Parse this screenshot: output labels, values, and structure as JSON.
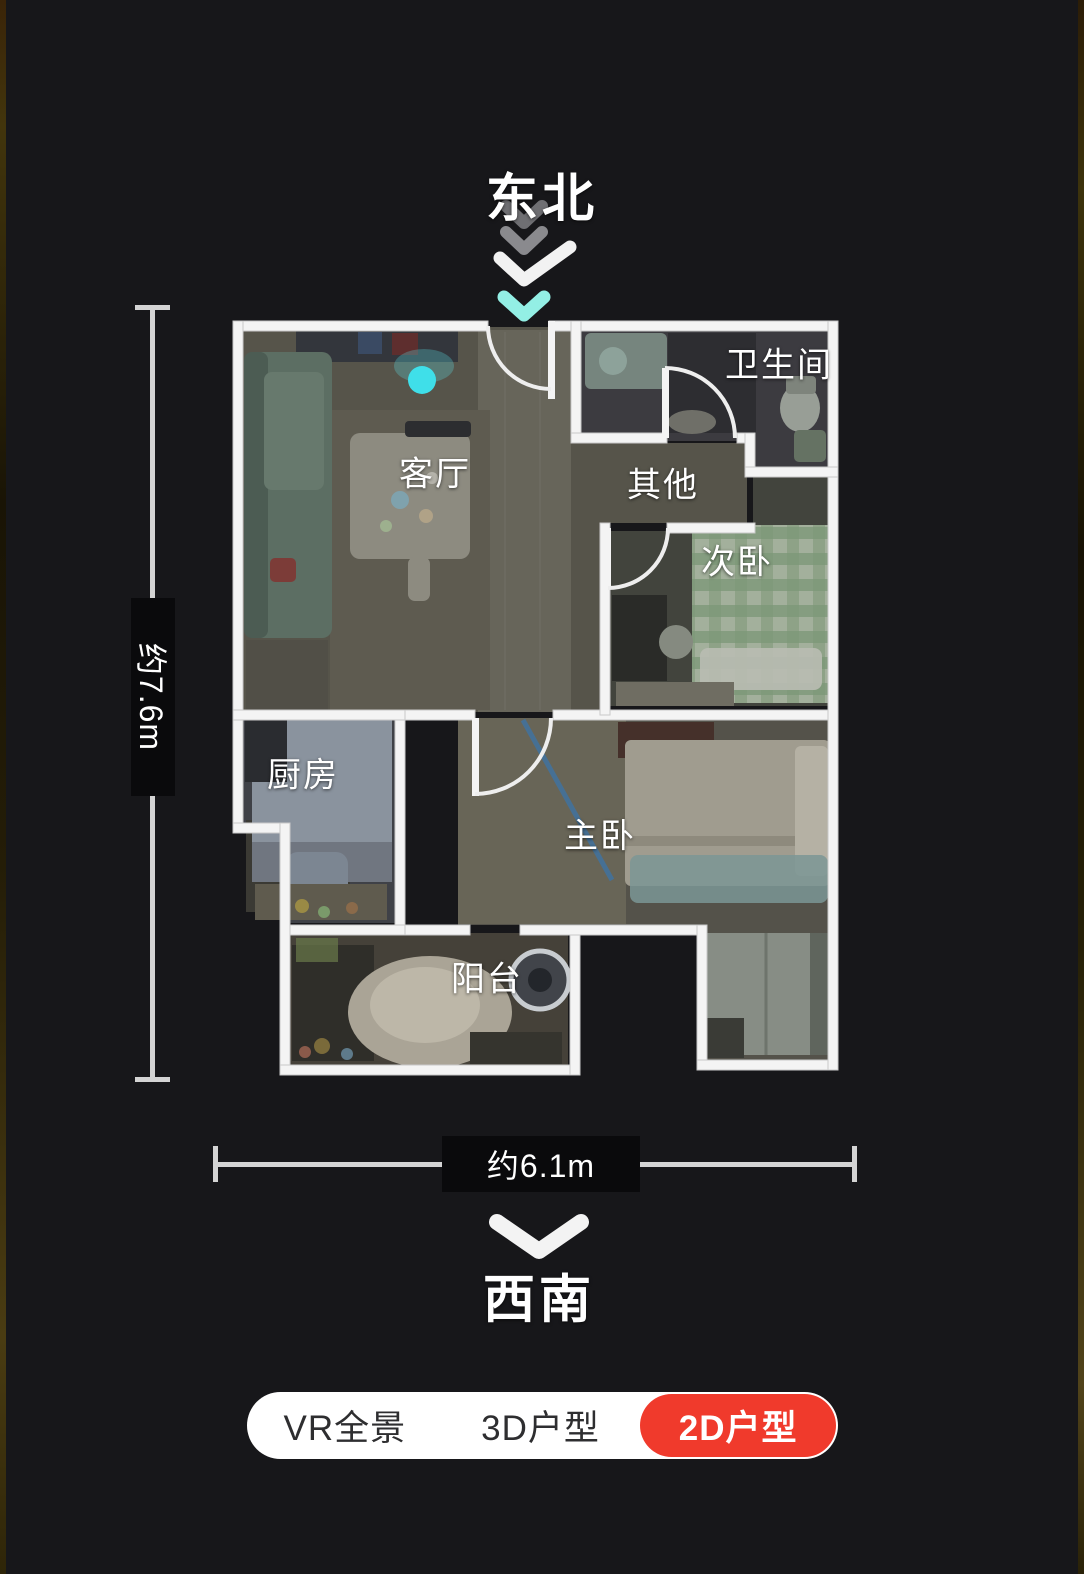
{
  "compass": {
    "top_direction": "东北",
    "bottom_direction": "西南"
  },
  "dimensions": {
    "vertical_label": "约7.6m",
    "horizontal_label": "约6.1m"
  },
  "rooms": {
    "living_room": {
      "label": "客厅"
    },
    "bathroom": {
      "label": "卫生间"
    },
    "other": {
      "label": "其他"
    },
    "second_bedroom": {
      "label": "次卧"
    },
    "kitchen": {
      "label": "厨房"
    },
    "master_bedroom": {
      "label": "主卧"
    },
    "balcony": {
      "label": "阳台"
    }
  },
  "view_toggle": {
    "options": [
      {
        "label": "VR全景",
        "active": false
      },
      {
        "label": "3D户型",
        "active": false
      },
      {
        "label": "2D户型",
        "active": true
      }
    ]
  },
  "colors": {
    "background": "#17171a",
    "wall_white": "#f4f4f4",
    "active_tab_red": "#f03a2c",
    "camera_dot_cyan": "#3fdfe9",
    "entry_chevron_cyan": "#93efe5",
    "dimension_line_gray": "#d4d4d4"
  }
}
